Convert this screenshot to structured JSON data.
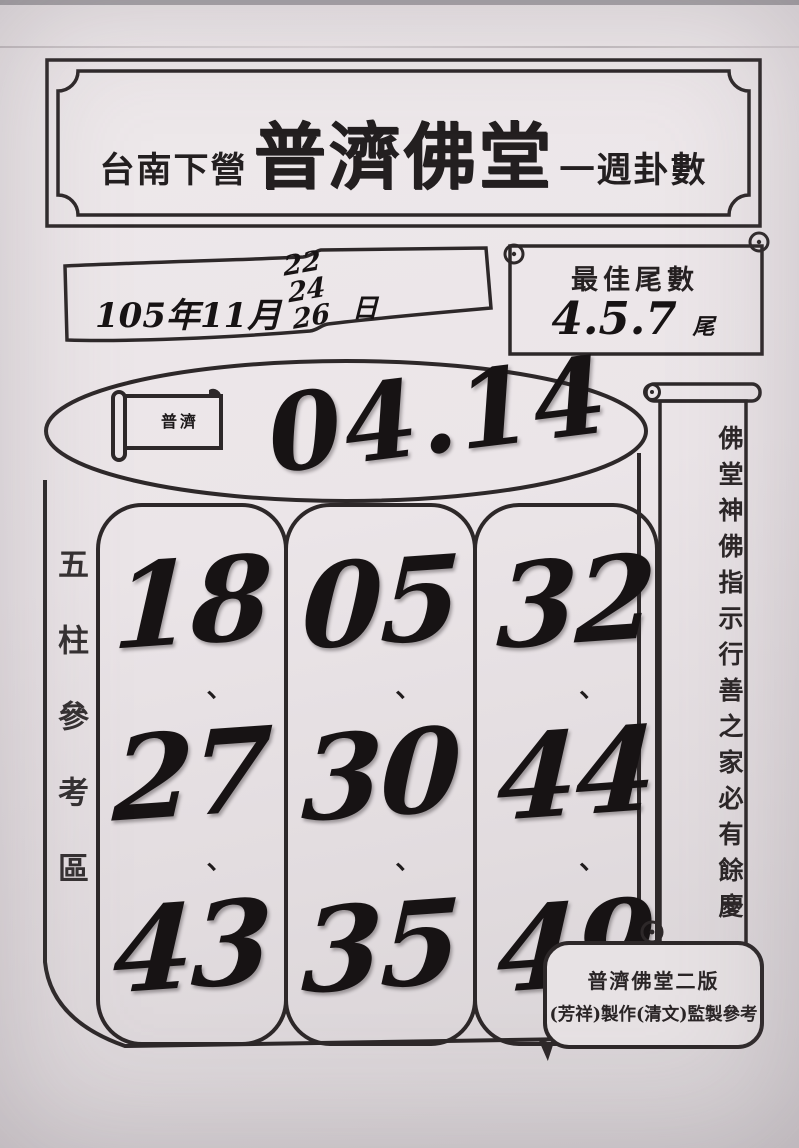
{
  "title_plaque": {
    "prefix": "台南下營",
    "main": "普濟佛堂",
    "suffix": "一週卦數"
  },
  "date_scroll": {
    "year_month": "105年11月",
    "days": [
      "22",
      "24",
      "26"
    ],
    "day_suffix": "日"
  },
  "best_tail_scroll": {
    "label": "最佳尾數",
    "value": "4.5.7",
    "unit": "尾"
  },
  "drum": {
    "flag_text": "普濟",
    "top_numbers": "04.14",
    "tick": "、",
    "columns": [
      {
        "numbers": [
          "18",
          "27",
          "43"
        ]
      },
      {
        "numbers": [
          "05",
          "30",
          "35"
        ]
      },
      {
        "numbers": [
          "32",
          "44",
          "49"
        ]
      }
    ]
  },
  "left_vertical_label": "五柱參考區",
  "right_banner": "佛堂神佛指示行善之家必有餘慶",
  "footer_box": {
    "line1": "普濟佛堂二版",
    "line2": "(芳祥)製作(清文)監製參考"
  },
  "colors": {
    "ink": "#2d2829",
    "paper": "#ebe5e8"
  }
}
